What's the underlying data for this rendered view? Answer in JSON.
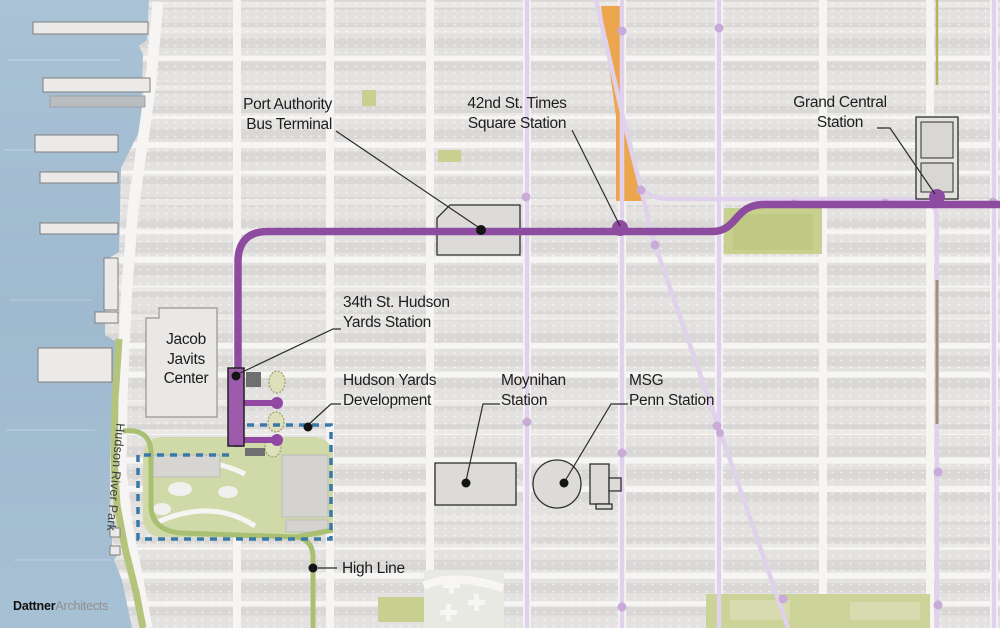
{
  "labels": {
    "port_authority": {
      "line1": "Port Authority",
      "line2": "Bus Terminal"
    },
    "times_square": {
      "line1": "42nd St. Times",
      "line2": "Square Station"
    },
    "grand_central": {
      "line1": "Grand Central",
      "line2": "Station"
    },
    "hudson_yards_station": {
      "line1": "34th St. Hudson",
      "line2": "Yards Station"
    },
    "javits": {
      "line1": "Jacob",
      "line2": "Javits",
      "line3": "Center"
    },
    "hudson_yards_dev": {
      "line1": "Hudson Yards",
      "line2": "Development"
    },
    "moynihan": {
      "line1": "Moynihan",
      "line2": "Station"
    },
    "msg": {
      "line1": "MSG",
      "line2": "Penn Station"
    },
    "high_line": {
      "text": "High Line"
    },
    "hudson_river_park": {
      "text": "Hudson River Park"
    },
    "logo": {
      "bold": "Dattner",
      "light": "Architects"
    }
  },
  "colors": {
    "water": "#a6bfd3",
    "street": "#f6f5f3",
    "block": "#e3e2e0",
    "subway_7_purple": "#8e4ca0",
    "light_route_purple": "#e0d1ec",
    "route_dot_purple": "#c9aad8",
    "times_square_orange": "#eca64e",
    "park_green": "#c7d08e",
    "high_line_green": "#a9bf72",
    "development_dash_blue": "#3a79a7",
    "leader_black": "#2b2b2b"
  }
}
